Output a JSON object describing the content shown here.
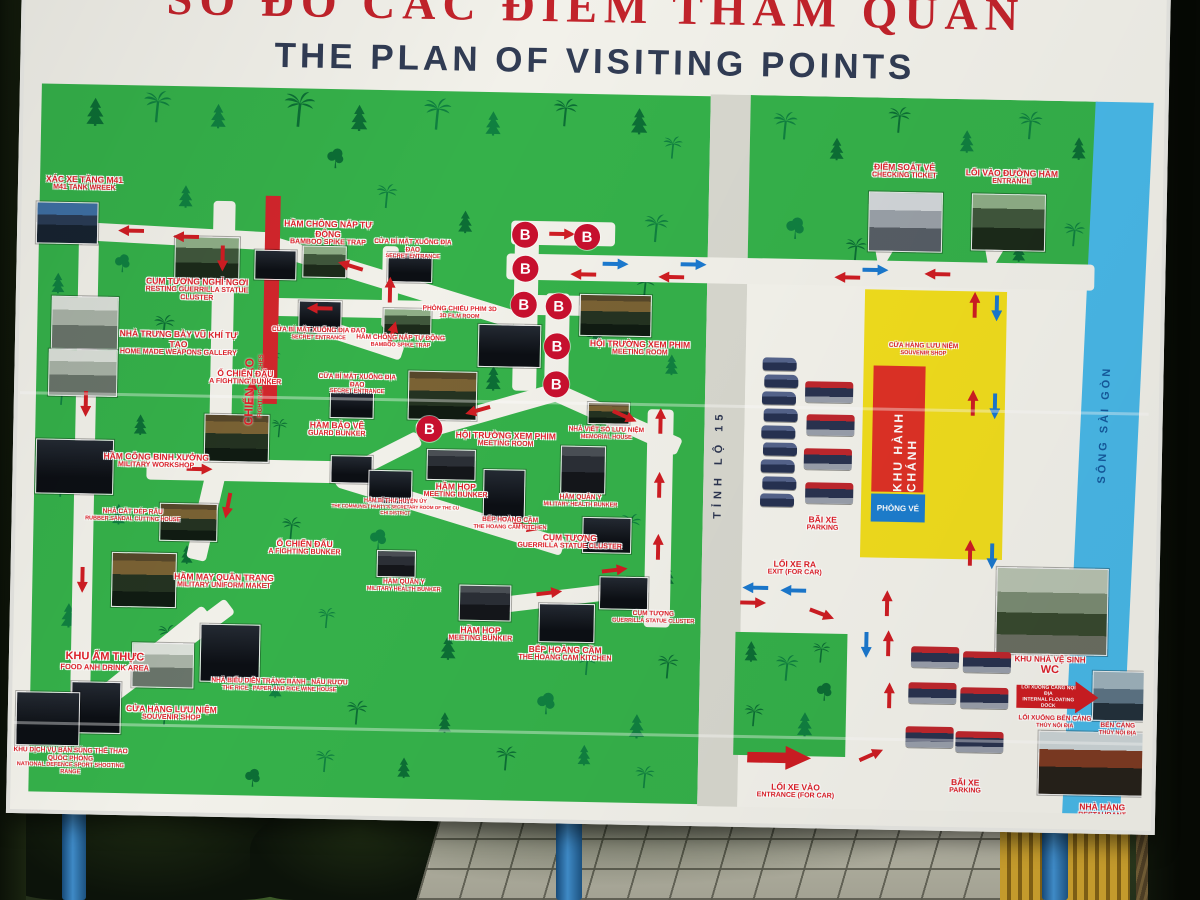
{
  "title": {
    "vi": "SƠ ĐỒ CÁC ĐIỂM THAM QUAN",
    "en": "THE PLAN OF VISITING POINTS"
  },
  "roads": {
    "provincial": "TỈNH LỘ 15",
    "river": "SÔNG SÀI GÒN"
  },
  "areas": {
    "admin": "KHU HÀNH CHÁNH",
    "ticket_office": "PHÒNG VÉ"
  },
  "marker_b": "B",
  "colors": {
    "map_green": "#35b14a",
    "tree_green": "#0c6e35",
    "label_red": "#df1f28",
    "river_blue": "#49b9e9",
    "yellow_zone": "#f2de1d",
    "arrow_red": "#cf1d23",
    "arrow_blue": "#1b79cf"
  },
  "pois": [
    {
      "vi": "XÁC XE TĂNG M41",
      "en": "M41 TANK WREEK"
    },
    {
      "vi": "CỤM TƯỢNG NGHỈ NGƠI",
      "en": "RESTING GUERRILLA STATUE CLUSTER"
    },
    {
      "vi": "NHÀ TRƯNG BÀY VŨ KHÍ TỰ TẠO",
      "en": "HOME MADE WEAPONS GALLERY"
    },
    {
      "vi": "HẦM CHÔNG NẮP TỰ ĐỘNG",
      "en": "BAMBOO SPIKE TRAP"
    },
    {
      "vi": "CỬA BÍ MẬT XUỐNG ĐỊA ĐẠO",
      "en": "SECRET ENTRANCE"
    },
    {
      "vi": "CHIẾN HÀO",
      "en": "FIGHTING TRENCHES"
    },
    {
      "vi": "PHÒNG CHIẾU PHIM 3D",
      "en": "3D FILM ROOM"
    },
    {
      "vi": "HỘI TRƯỜNG XEM PHIM",
      "en": "MEETING ROOM"
    },
    {
      "vi": "Ổ CHIẾN ĐẤU",
      "en": "A FIGHTING BUNKER"
    },
    {
      "vi": "HẦM BẢO VỆ",
      "en": "GUARD BUNKER"
    },
    {
      "vi": "NHÀ VIẾT SỔ LƯU NIỆM",
      "en": "MEMORIAL HOUSE"
    },
    {
      "vi": "HẦM CÔNG BINH XƯỞNG",
      "en": "MILITARY WORKSHOP"
    },
    {
      "vi": "HẦM BÍ THƯ HUYỆN ỦY",
      "en": "THE COMMUNIST PARTY'S SECRETARY ROOM OF THE CU CHI DISTRICT"
    },
    {
      "vi": "HẦM HỌP",
      "en": "MEETING BUNKER"
    },
    {
      "vi": "BẾP HOÀNG CẦM",
      "en": "THE HOANG CAM KITCHEN"
    },
    {
      "vi": "HẦM QUÂN Y",
      "en": "MILITARY HEALTH BUNKER"
    },
    {
      "vi": "CỤM TƯỢNG",
      "en": "GUERRILLA STATUE CLUSTER"
    },
    {
      "vi": "HẦM MAY QUÂN TRANG",
      "en": "MILITARY UNIFORM MAKET"
    },
    {
      "vi": "NHÀ CẮT DÉP RÂU",
      "en": "RUBBER SANDAL CUTTING HOUSE"
    },
    {
      "vi": "KHU ẨM THỰC",
      "en": "FOOD ANH DRINK AREA"
    },
    {
      "vi": "NHÀ BIỂU DIỄN TRÁNG BÁNH - NẤU RƯỢU",
      "en": "THE RICE - PAPER AND RICE WINE HOUSE"
    },
    {
      "vi": "CỬA HÀNG LƯU NIỆM",
      "en": "SOUVENIR SHOP"
    },
    {
      "vi": "KHU DỊCH VỤ BẮN SÚNG THỂ THAO QUỐC PHÒNG",
      "en": "NATIONAL DEFENCE SPORT SHOOTING RANGE"
    },
    {
      "vi": "ĐIỂM SOÁT VÉ",
      "en": "CHECKING TICKET"
    },
    {
      "vi": "LỐI VÀO ĐƯỜNG HẦM",
      "en": "ENTRANCE"
    },
    {
      "vi": "BÃI XE",
      "en": "PARKING"
    },
    {
      "vi": "LỐI XE RA",
      "en": "EXIT (FOR CAR)"
    },
    {
      "vi": "KHU NHÀ VỆ SINH",
      "en": "WC"
    },
    {
      "vi": "LỐI XUỐNG CẢNG NỘI ĐỊA",
      "en": "INTERNAL FLOATING DOCK"
    },
    {
      "vi": "LỐI XUỐNG BẾN CẢNG",
      "en": "THỦY NỘI ĐỊA"
    },
    {
      "vi": "BẾN CẢNG",
      "en": "THỦY NỘI ĐỊA"
    },
    {
      "vi": "NHÀ HÀNG",
      "en": "RESTAURANT"
    },
    {
      "vi": "LỐI XE VÀO",
      "en": "ENTRANCE (FOR CAR)"
    }
  ]
}
